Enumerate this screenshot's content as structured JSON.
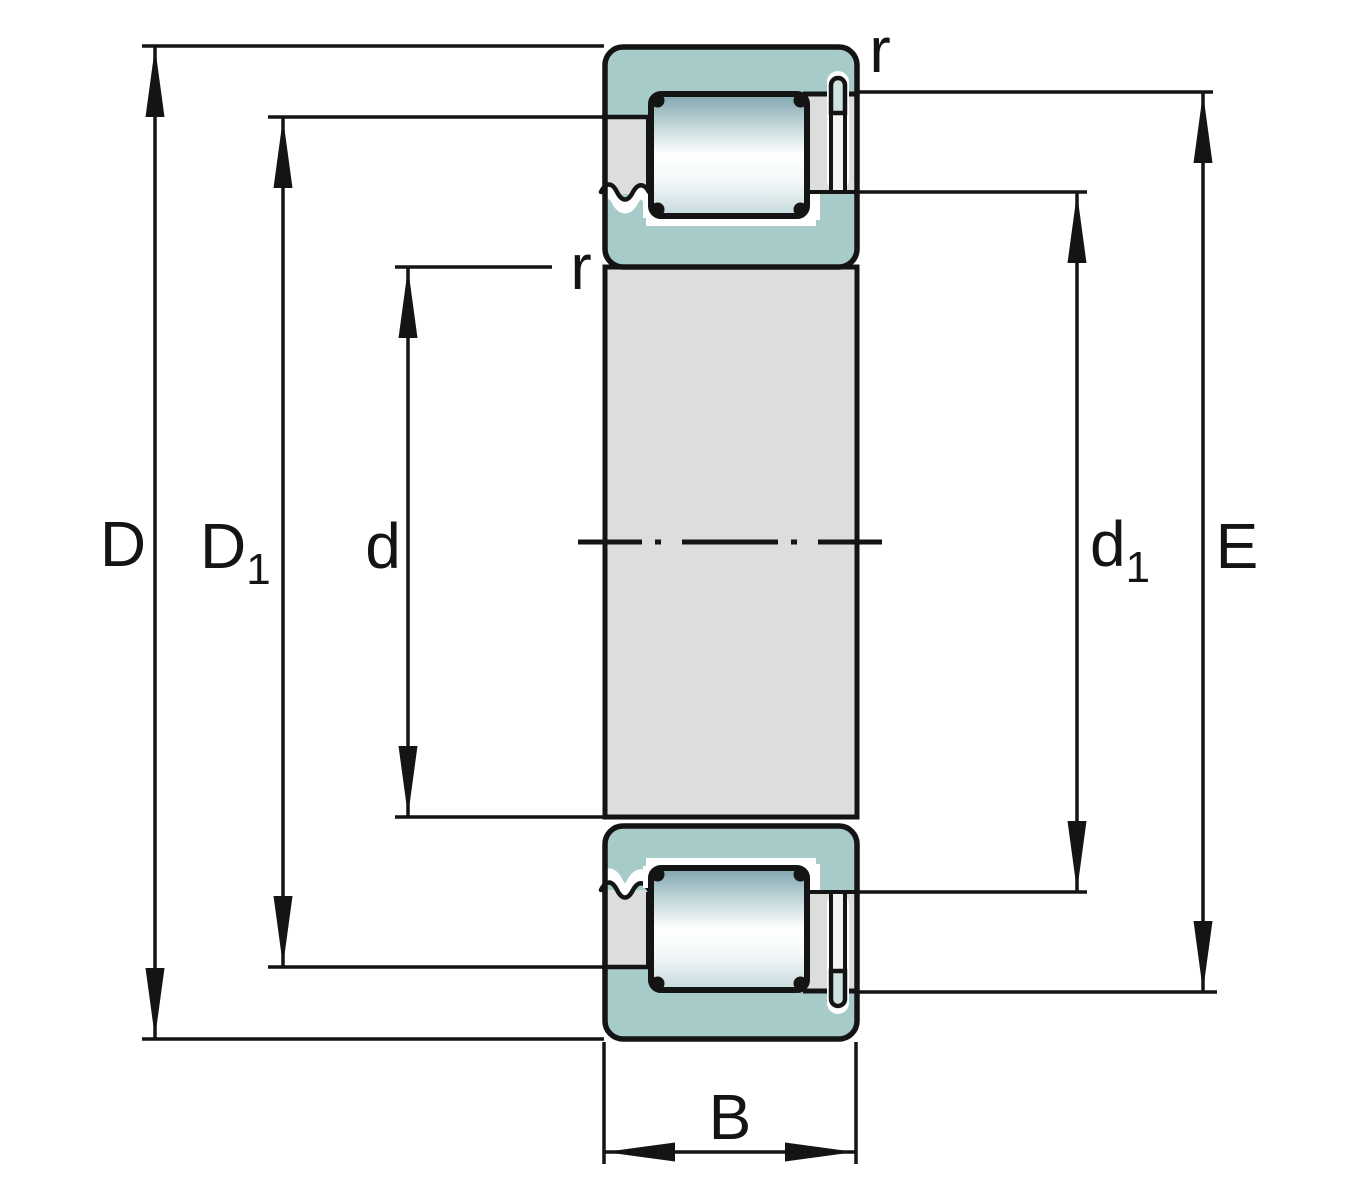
{
  "figure": {
    "dimension_labels": {
      "D": {
        "main": "D",
        "sub": ""
      },
      "D1": {
        "main": "D",
        "sub": "1"
      },
      "d": {
        "main": "d",
        "sub": ""
      },
      "d1": {
        "main": "d",
        "sub": "1"
      },
      "E": {
        "main": "E",
        "sub": ""
      },
      "B": {
        "main": "B",
        "sub": ""
      }
    },
    "radius_labels": {
      "outer": "r",
      "inner": "r"
    },
    "colors": {
      "background": "#ffffff",
      "outline": "#141414",
      "ring": "#a6cbc8",
      "ring_light": "#cfe3e1",
      "steel": "#dcdddd",
      "pin_body": "#f2f4f4",
      "roller_top": "#7ea4ad",
      "roller_upper": "#c3d7da",
      "roller_highlight": "#ffffff",
      "roller_lower": "#f2f7f8",
      "roller_bottom": "#c6d9dd"
    }
  }
}
